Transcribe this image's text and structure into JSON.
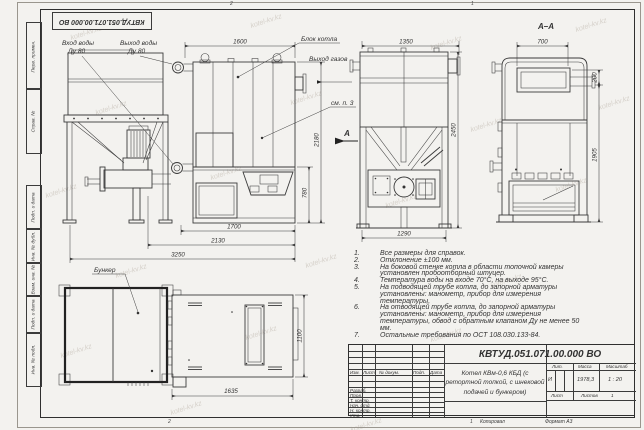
{
  "watermark": "kotel-kv.kz",
  "doc_number": "КВТУД.051.071.00.000 ВО",
  "zones": {
    "top_left": "2",
    "top_right": "1",
    "bottom_left": "2",
    "bottom_right": "1"
  },
  "side_stamp": [
    "Перв. примен.",
    "Справ. №",
    "Подп. и дата",
    "Инв. № дубл.",
    "Взам. инв. №",
    "Подп. и дата",
    "Инв. № подл."
  ],
  "labels": {
    "water_inlet_1": "Вход воды",
    "water_inlet_2": "Ду 80",
    "water_outlet_1": "Выход воды",
    "water_outlet_2": "Ду 80",
    "boiler_block": "Блок котла",
    "gas_outlet": "Выход газов",
    "see_note": "см. п. 3",
    "view_arrow": "А",
    "section_title": "А–А",
    "bunker": "Бункер"
  },
  "dims": {
    "front_top": "1600",
    "front_h_total": "2180",
    "front_h_lower": "780",
    "front_b1": "1700",
    "front_b2": "2130",
    "front_b3": "3250",
    "side_top": "1350",
    "side_right": "2450",
    "side_bottom": "1290",
    "sec_top": "700",
    "sec_small": "200",
    "sec_right": "1905",
    "plan_bottom": "1635",
    "plan_right": "1100"
  },
  "notes": {
    "items": [
      {
        "n": "1.",
        "t": "Все размеры для справок."
      },
      {
        "n": "2.",
        "t": "Отклонение ±100 мм."
      },
      {
        "n": "3.",
        "t": "На боковой стенке котла в области топочной камеры установлен пробоотборный штуцер."
      },
      {
        "n": "4.",
        "t": "Температура воды на входе 70°С, на выходе 95°С."
      },
      {
        "n": "5.",
        "t": "На подводящей трубе котла, до запорной арматуры установлены: манометр, прибор для измерения температуры."
      },
      {
        "n": "6.",
        "t": "На отводящей трубе котла, до запорной арматуры установлены: манометр, прибор для измерения температуры, обвод с обратным клапаном Ду не менее 50 мм."
      },
      {
        "n": "7.",
        "t": "Остальные требования по ОСТ 108.030.133-84."
      }
    ]
  },
  "title_block": {
    "name": "Котел КВм-0,6 КБД (с ретортной топкой, с шнековой подачей и бункером)",
    "cols": [
      "Изм.",
      "Лист",
      "№ докум.",
      "Подп.",
      "Дата"
    ],
    "rows": [
      "Разраб.",
      "Пров.",
      "Т. контр.",
      "Нач. отд.",
      "Н. контр.",
      "Утв."
    ],
    "lit_label": "Лит.",
    "lit_value": "И",
    "mass_label": "Масса",
    "mass_value": "1978,3",
    "scale_label": "Масштаб",
    "scale_value": "1 : 20",
    "sheet_label": "Лист",
    "sheets_label": "Листов",
    "sheets_count": "1",
    "copied": "Копировал",
    "format": "Формат А3"
  }
}
